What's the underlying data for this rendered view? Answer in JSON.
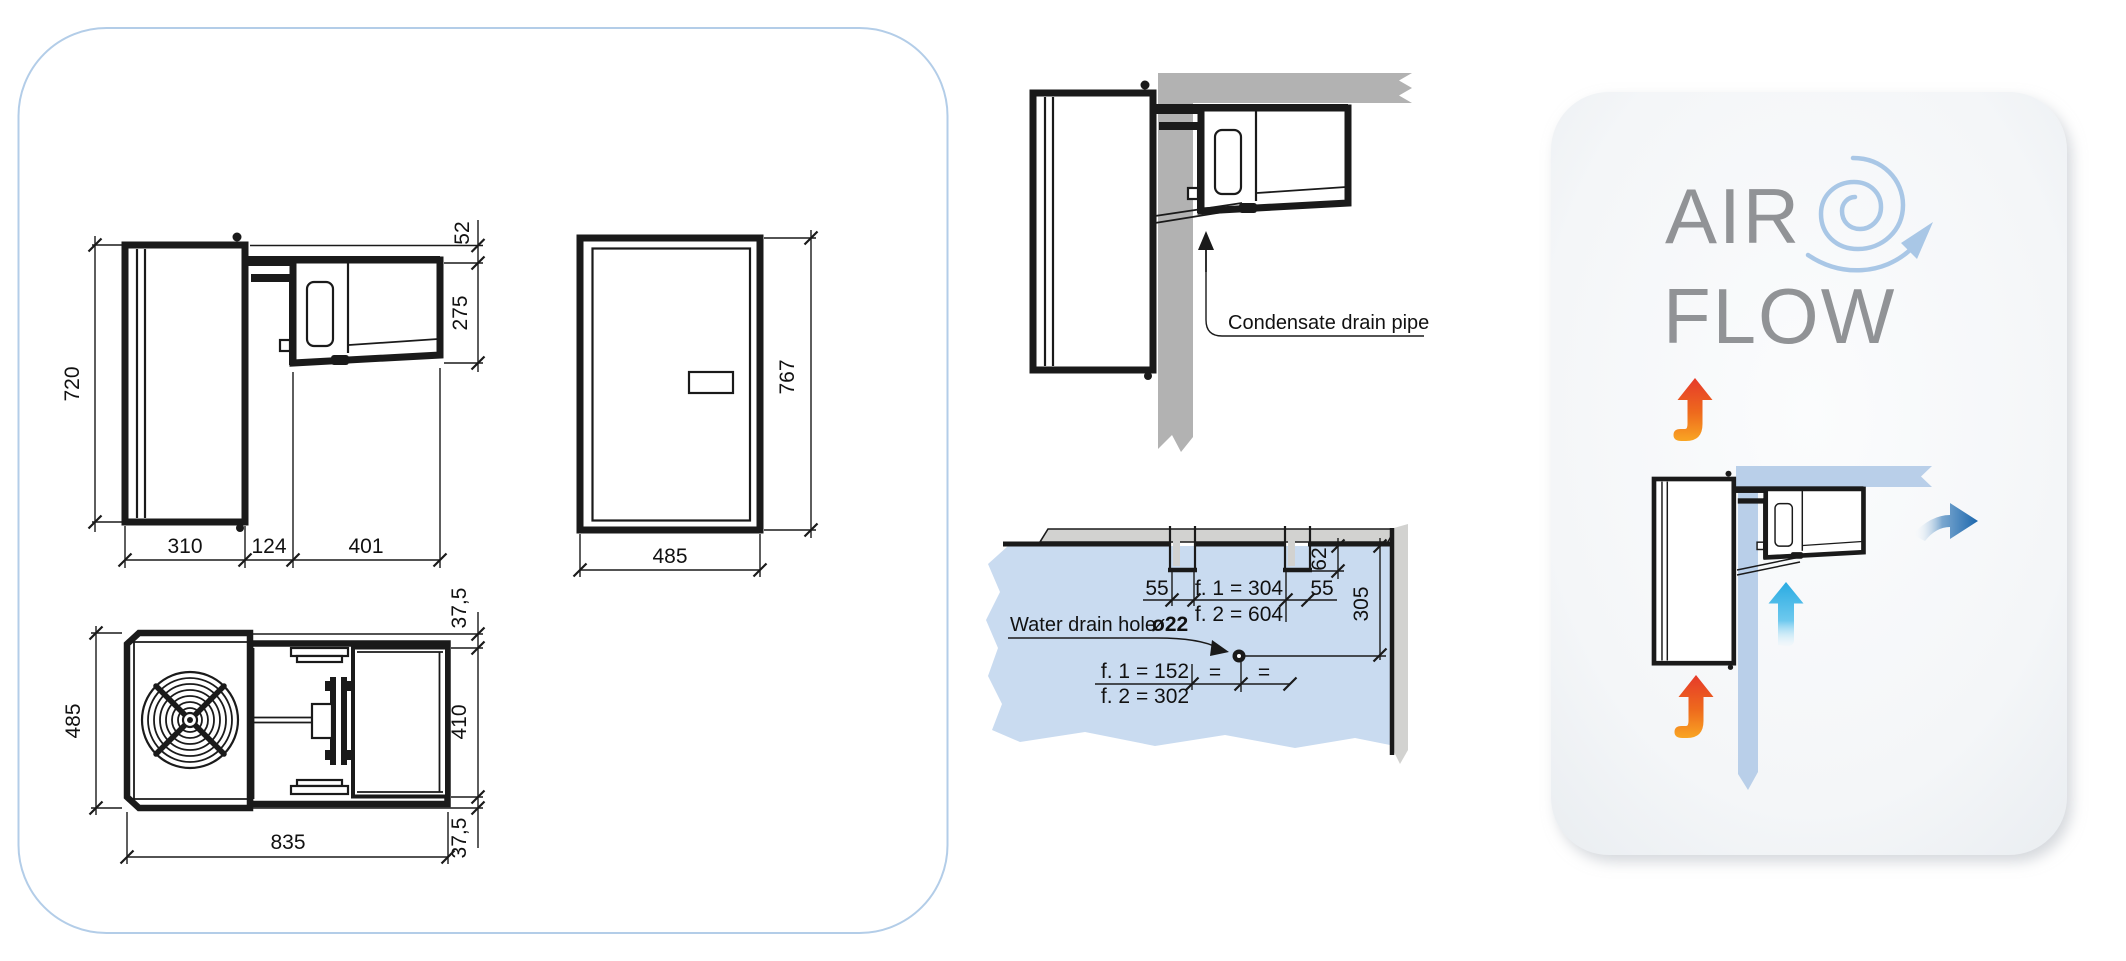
{
  "dimension_panel": {
    "side_view": {
      "dim_height": "720",
      "dim_width_left": "310",
      "dim_width_mid": "124",
      "dim_width_right": "401",
      "dim_top_right": "52",
      "dim_right": "275"
    },
    "front_view": {
      "dim_width": "485",
      "dim_height": "767"
    },
    "top_view": {
      "dim_depth": "485",
      "dim_offset_top": "37,5",
      "dim_condenser": "410",
      "dim_offset_bottom": "37,5",
      "dim_width": "835"
    }
  },
  "installation": {
    "condensate": {
      "label": "Condensate drain pipe"
    },
    "water_drain": {
      "label": "Water drain hole",
      "hole_diameter": "ø22",
      "dim_left_margin": "55",
      "dim_f1_top": "f. 1 = 304",
      "dim_f2_top": "f. 2 = 604",
      "dim_right_margin": "55",
      "dim_notch_depth": "62",
      "dim_wall_offset": "305",
      "dim_f1_bottom": "f. 1 = 152",
      "dim_f2_bottom": "f. 2 = 302",
      "equals_left": "=",
      "equals_right": "="
    }
  },
  "airflow_panel": {
    "title_line1": "AIR",
    "title_line2": "FLOW"
  },
  "colors": {
    "panel_border": "#b3cde8",
    "line": "#1a1a1a",
    "wall_gray": "#b2b2b2",
    "face_gray": "#d2d2d0",
    "floor_blue": "#c9dbf0",
    "band_blue": "#b9cfe9",
    "spiral_blue": "#a9c7e6",
    "title_gray": "#919396",
    "hot_red": "#e63a2a",
    "hot_orange": "#f9a523",
    "cold_cyan": "#29abe2",
    "cold_dark_blue": "#1c67ad"
  }
}
